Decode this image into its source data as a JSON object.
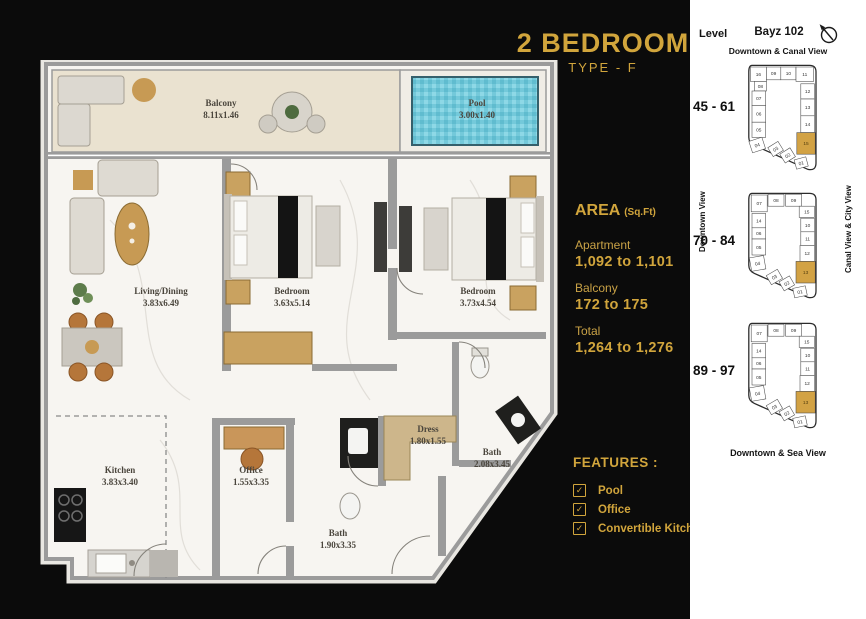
{
  "colors": {
    "gold": "#D1A53C",
    "highlight": "#D2A244",
    "pool": "#74C9DA",
    "background": "#0B0B0B",
    "wall": "#9B9B9B"
  },
  "title": {
    "main": "2 BEDROOM",
    "sub": "TYPE - F"
  },
  "area": {
    "heading": "AREA",
    "heading_unit": "(Sq.Ft)",
    "items": [
      {
        "label": "Apartment",
        "value": "1,092 to 1,101"
      },
      {
        "label": "Balcony",
        "value": "172 to 175"
      },
      {
        "label": "Total",
        "value": "1,264 to 1,276"
      }
    ]
  },
  "features": {
    "heading": "FEATURES :",
    "check_glyph": "✓",
    "items": [
      "Pool",
      "Office",
      "Convertible Kitchen"
    ]
  },
  "plan": {
    "labels": [
      {
        "name": "Balcony",
        "dims": "8.11x1.46"
      },
      {
        "name": "Pool",
        "dims": "3.00x1.40"
      },
      {
        "name": "Living/Dining",
        "dims": "3.83x6.49"
      },
      {
        "name": "Bedroom",
        "dims": "3.63x5.14"
      },
      {
        "name": "Bedroom",
        "dims": "3.73x4.54"
      },
      {
        "name": "Kitchen",
        "dims": "3.83x3.40"
      },
      {
        "name": "Office",
        "dims": "1.55x3.35"
      },
      {
        "name": "Bath",
        "dims": "1.90x3.35"
      },
      {
        "name": "Dress",
        "dims": "1.80x1.55"
      },
      {
        "name": "Bath",
        "dims": "2.08x3.45"
      }
    ]
  },
  "sidebar": {
    "level_heading": "Level",
    "building": "Bayz 102",
    "views": {
      "top": "Downtown & Canal View",
      "bottom": "Downtown & Sea View",
      "left": "Downtown View",
      "right": "Canal View & City View"
    },
    "keyplans": [
      {
        "levels": "45 - 61",
        "units": [
          {
            "n": "16",
            "x": 13,
            "y": 5,
            "w": 20,
            "h": 18
          },
          {
            "n": "09",
            "x": 33,
            "y": 5,
            "w": 18,
            "h": 16
          },
          {
            "n": "10",
            "x": 51,
            "y": 5,
            "w": 19,
            "h": 16
          },
          {
            "n": "11",
            "x": 70,
            "y": 5,
            "w": 22,
            "h": 18
          },
          {
            "n": "08",
            "x": 18,
            "y": 23,
            "w": 15,
            "h": 12
          },
          {
            "n": "07",
            "x": 15,
            "y": 35,
            "w": 17,
            "h": 18
          },
          {
            "n": "06",
            "x": 15,
            "y": 53,
            "w": 17,
            "h": 21
          },
          {
            "n": "05",
            "x": 15,
            "y": 74,
            "w": 17,
            "h": 19
          },
          {
            "n": "04",
            "x": 13,
            "y": 95,
            "w": 17,
            "h": 15,
            "r": -18
          },
          {
            "n": "12",
            "x": 76,
            "y": 26,
            "w": 17,
            "h": 19
          },
          {
            "n": "13",
            "x": 76,
            "y": 45,
            "w": 17,
            "h": 21
          },
          {
            "n": "14",
            "x": 76,
            "y": 66,
            "w": 17,
            "h": 21
          },
          {
            "n": "15",
            "x": 71,
            "y": 87,
            "w": 23,
            "h": 27,
            "hl": true
          },
          {
            "n": "03",
            "x": 37,
            "y": 101,
            "w": 15,
            "h": 13,
            "r": -32
          },
          {
            "n": "02",
            "x": 52,
            "y": 109,
            "w": 15,
            "h": 13,
            "r": -32
          },
          {
            "n": "01",
            "x": 69,
            "y": 119,
            "w": 15,
            "h": 12,
            "r": -15
          }
        ]
      },
      {
        "levels": "70 - 84",
        "units": [
          {
            "n": "07",
            "x": 14,
            "y": 5,
            "w": 20,
            "h": 21
          },
          {
            "n": "08",
            "x": 35,
            "y": 4,
            "w": 20,
            "h": 15
          },
          {
            "n": "09",
            "x": 57,
            "y": 4,
            "w": 20,
            "h": 15
          },
          {
            "n": "15",
            "x": 74,
            "y": 19,
            "w": 19,
            "h": 14
          },
          {
            "n": "10",
            "x": 76,
            "y": 34,
            "w": 17,
            "h": 17
          },
          {
            "n": "11",
            "x": 76,
            "y": 51,
            "w": 17,
            "h": 17
          },
          {
            "n": "12",
            "x": 75,
            "y": 68,
            "w": 18,
            "h": 20
          },
          {
            "n": "13",
            "x": 70,
            "y": 88,
            "w": 24,
            "h": 27,
            "hl": true
          },
          {
            "n": "14",
            "x": 15,
            "y": 28,
            "w": 17,
            "h": 18
          },
          {
            "n": "06",
            "x": 15,
            "y": 46,
            "w": 17,
            "h": 14
          },
          {
            "n": "05",
            "x": 15,
            "y": 60,
            "w": 17,
            "h": 20
          },
          {
            "n": "04",
            "x": 13,
            "y": 82,
            "w": 18,
            "h": 17,
            "r": -10
          },
          {
            "n": "03",
            "x": 35,
            "y": 101,
            "w": 16,
            "h": 13,
            "r": -30
          },
          {
            "n": "02",
            "x": 51,
            "y": 109,
            "w": 15,
            "h": 13,
            "r": -30
          },
          {
            "n": "01",
            "x": 67,
            "y": 120,
            "w": 16,
            "h": 12,
            "r": -12
          }
        ]
      },
      {
        "levels": "89 - 97",
        "units": [
          {
            "n": "07",
            "x": 14,
            "y": 5,
            "w": 20,
            "h": 21
          },
          {
            "n": "08",
            "x": 35,
            "y": 4,
            "w": 20,
            "h": 15
          },
          {
            "n": "09",
            "x": 57,
            "y": 4,
            "w": 20,
            "h": 15
          },
          {
            "n": "15",
            "x": 74,
            "y": 19,
            "w": 19,
            "h": 14
          },
          {
            "n": "10",
            "x": 76,
            "y": 34,
            "w": 17,
            "h": 17
          },
          {
            "n": "11",
            "x": 76,
            "y": 51,
            "w": 17,
            "h": 17
          },
          {
            "n": "12",
            "x": 75,
            "y": 68,
            "w": 18,
            "h": 20
          },
          {
            "n": "13",
            "x": 70,
            "y": 88,
            "w": 24,
            "h": 27,
            "hl": true
          },
          {
            "n": "14",
            "x": 15,
            "y": 28,
            "w": 17,
            "h": 18
          },
          {
            "n": "06",
            "x": 15,
            "y": 46,
            "w": 17,
            "h": 14
          },
          {
            "n": "05",
            "x": 15,
            "y": 60,
            "w": 17,
            "h": 20
          },
          {
            "n": "04",
            "x": 13,
            "y": 82,
            "w": 18,
            "h": 17,
            "r": -10
          },
          {
            "n": "03",
            "x": 35,
            "y": 101,
            "w": 16,
            "h": 13,
            "r": -30
          },
          {
            "n": "02",
            "x": 51,
            "y": 109,
            "w": 15,
            "h": 13,
            "r": -30
          },
          {
            "n": "01",
            "x": 67,
            "y": 120,
            "w": 16,
            "h": 12,
            "r": -12
          }
        ]
      }
    ]
  }
}
